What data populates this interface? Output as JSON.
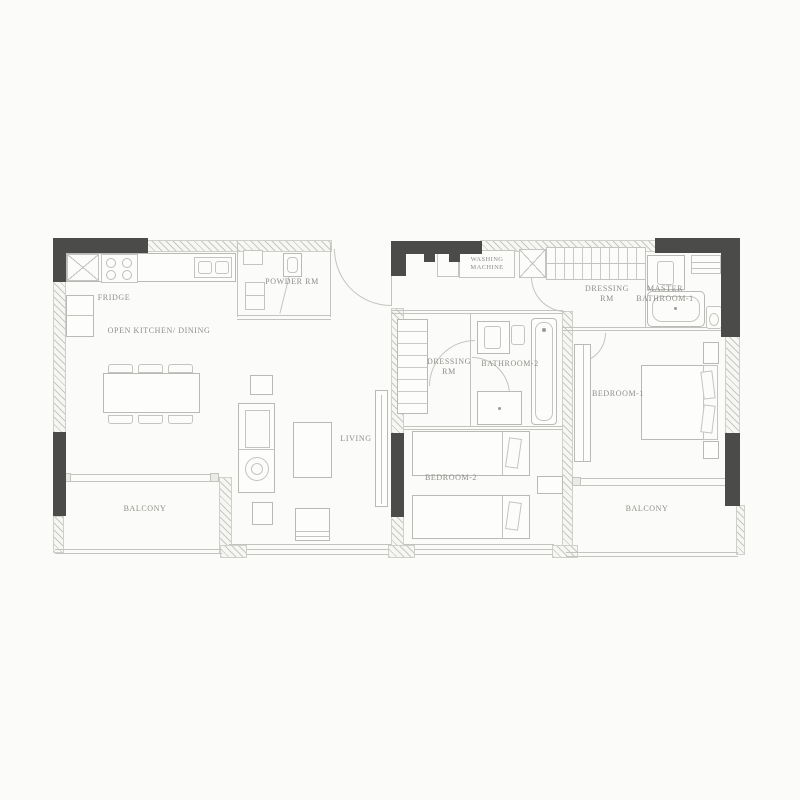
{
  "colors": {
    "wall_dark": "#4b4b49",
    "line": "#b9b9b6",
    "label": "#8d8d89",
    "background": "#fbfbf9"
  },
  "rooms": [
    {
      "id": "fridge",
      "label": "FRIDGE"
    },
    {
      "id": "open-kitchen-dining",
      "label": "OPEN KITCHEN/ DINING"
    },
    {
      "id": "powder-rm",
      "label": "POWDER RM"
    },
    {
      "id": "washing-machine",
      "label": "WASHING MACHINE"
    },
    {
      "id": "dressing-rm-master",
      "label": "DRESSING RM"
    },
    {
      "id": "master-bathroom-1",
      "label": "MASTER BATHROOM-1"
    },
    {
      "id": "dressing-rm-2",
      "label": "DRESSING RM"
    },
    {
      "id": "bathroom-2",
      "label": "BATHROOM-2"
    },
    {
      "id": "bedroom-1",
      "label": "BEDROOM-1"
    },
    {
      "id": "living",
      "label": "LIVING"
    },
    {
      "id": "bedroom-2",
      "label": "BEDROOM-2"
    },
    {
      "id": "balcony-left",
      "label": "BALCONY"
    },
    {
      "id": "balcony-right",
      "label": "BALCONY"
    }
  ]
}
